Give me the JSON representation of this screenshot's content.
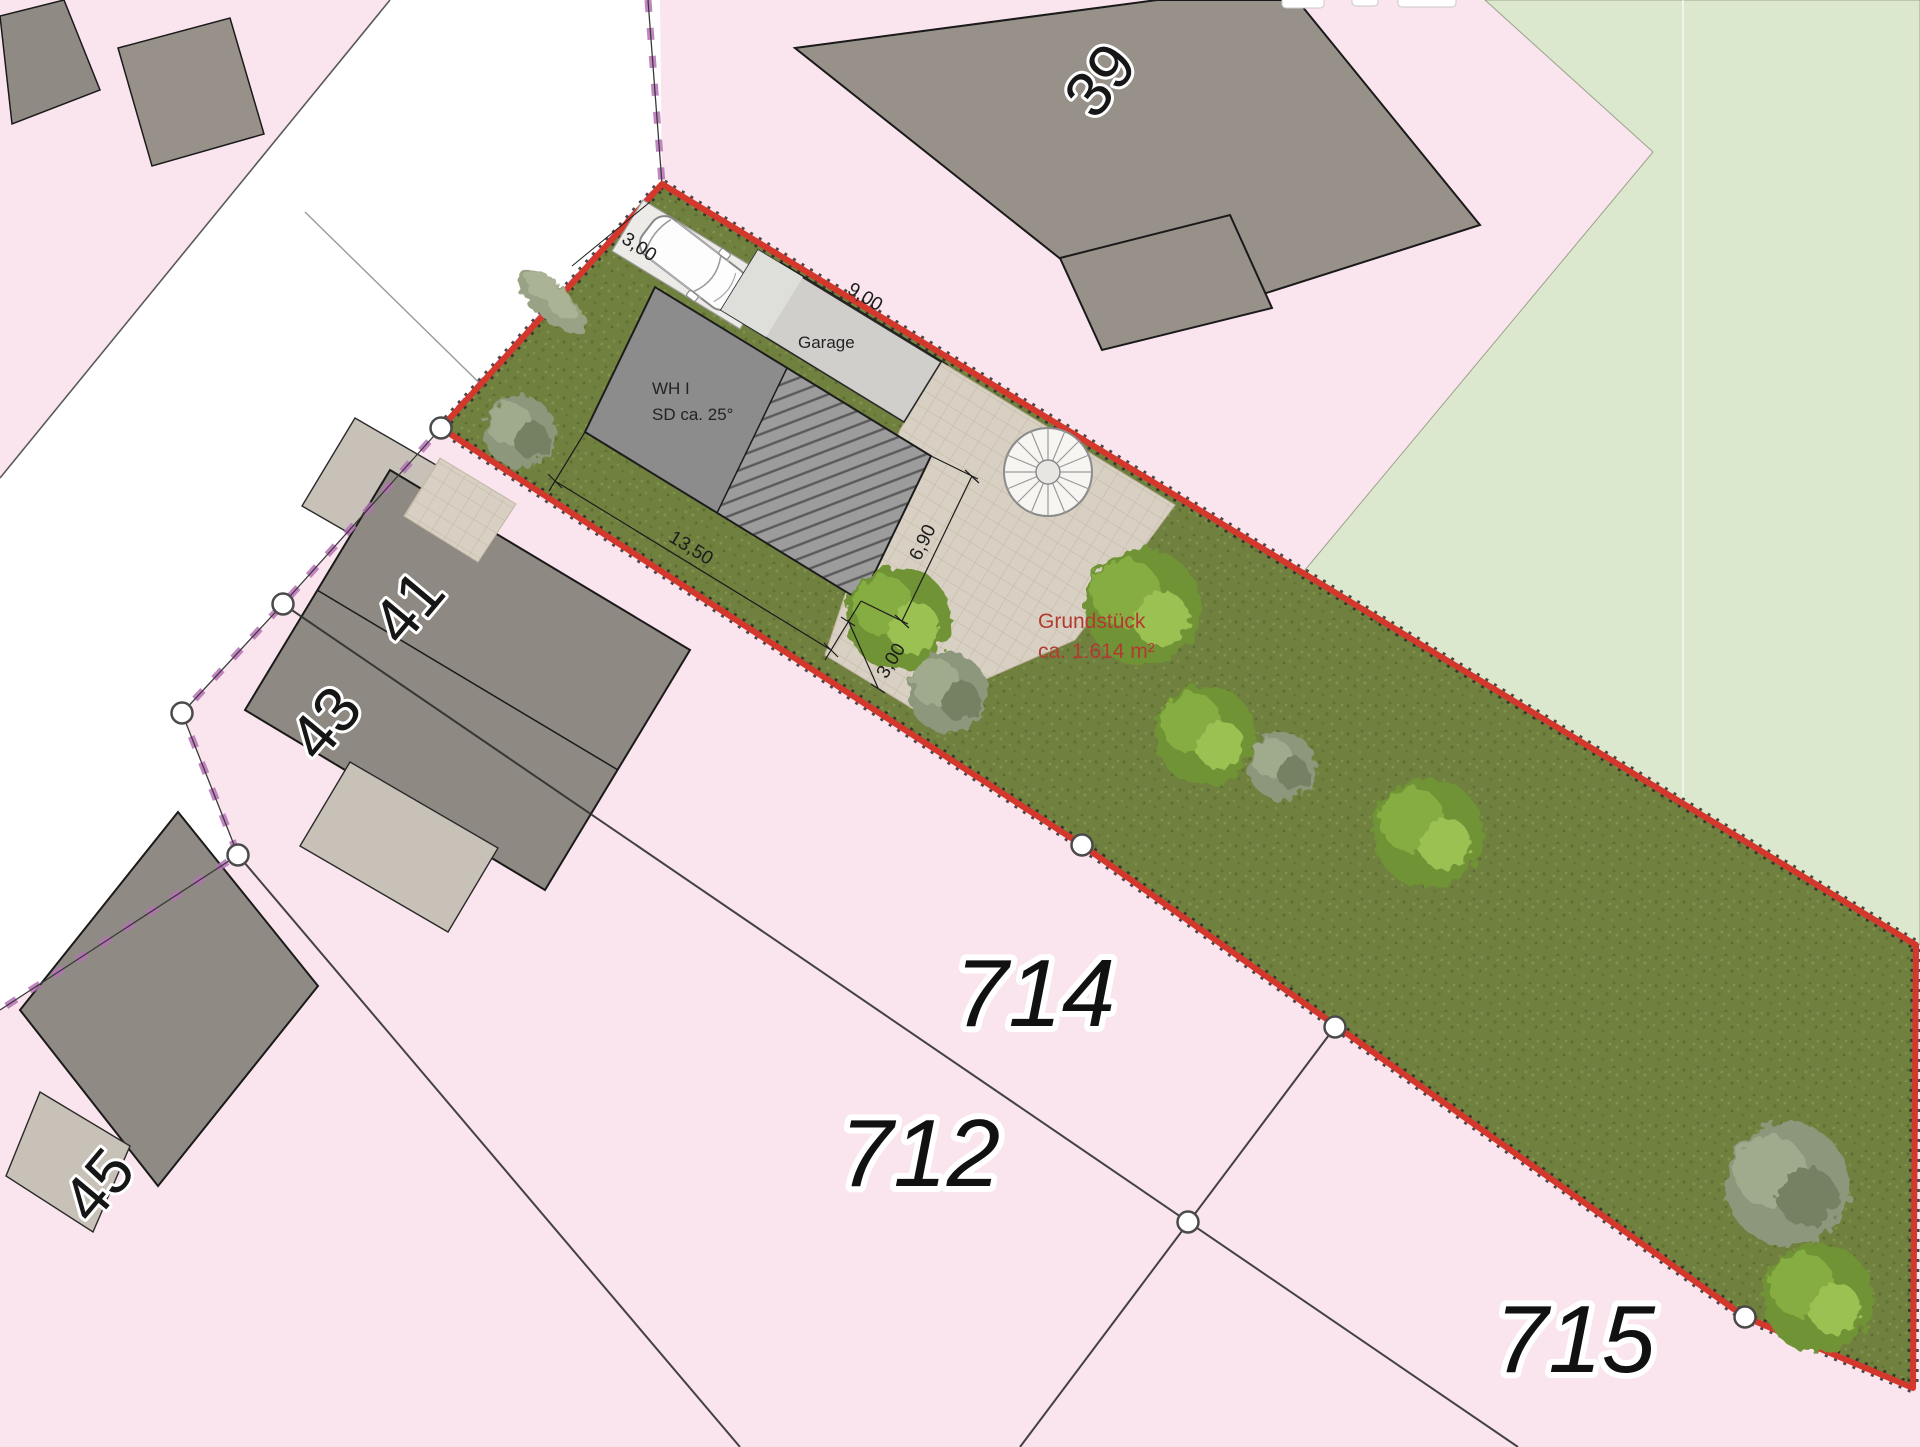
{
  "annotations": {
    "house_label_line1": "WH I",
    "house_label_line2": "SD ca. 25°",
    "garage_label": "Garage",
    "area_label_line1": "Grundstück",
    "area_label_line2": "ca. 1.614 m²"
  },
  "dimensions": {
    "parking_width": "3,00",
    "garage_length": "9,00",
    "house_length": "13,50",
    "house_depth": "6,90",
    "setback": "3,00"
  },
  "parcel_numbers": {
    "n39": "39",
    "n41": "41",
    "n43": "43",
    "n45": "45",
    "n714": "714",
    "n712": "712",
    "n715": "715"
  },
  "colors": {
    "boundary_red": "#d4382c",
    "cadastral_violet": "#b671b6",
    "parcel_pink": "#fae4ed",
    "field_green": "#dce8cd",
    "grass_green": "#70803f",
    "building_gray": "#97918a",
    "area_text_red": "#b23a31"
  }
}
